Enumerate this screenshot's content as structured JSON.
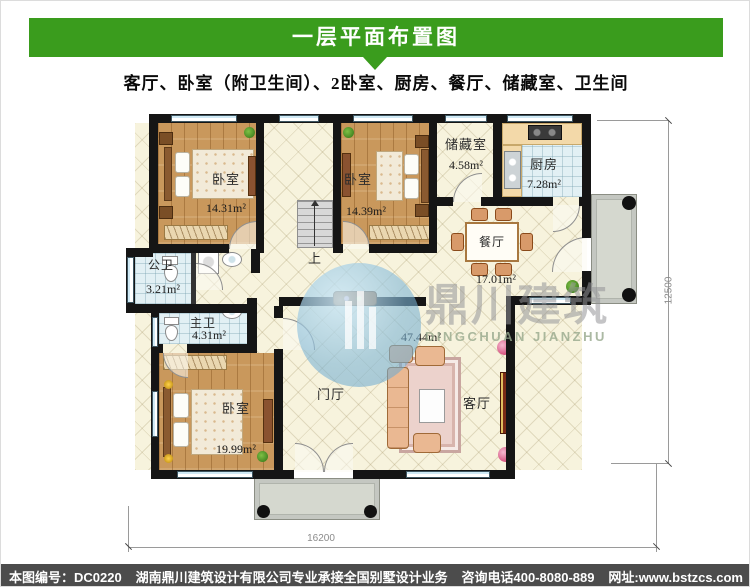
{
  "header": {
    "title": "一层平面布置图",
    "subtitle": "客厅、卧室（附卫生间）、2卧室、厨房、餐厅、储藏室、卫生间"
  },
  "colors": {
    "accent_green": "#3a9c1d",
    "footer_bg": "#4c4c4c",
    "watermark_blue": "#7db5d6",
    "wall": "#151515"
  },
  "rooms": {
    "bedroom_nw": {
      "label": "卧室",
      "area": "14.31m²"
    },
    "bedroom_ne": {
      "label": "卧室",
      "area": "14.39m²"
    },
    "storage": {
      "label": "储藏室",
      "area": "4.58m²"
    },
    "kitchen": {
      "label": "厨房",
      "area": "7.28m²"
    },
    "dining": {
      "label": "餐厅",
      "area": "17.01m²"
    },
    "public_bath": {
      "label": "公卫",
      "area": "3.21m²"
    },
    "master_bath": {
      "label": "主卫",
      "area": "4.31m²"
    },
    "bedroom_sw": {
      "label": "卧室",
      "area": "19.99m²"
    },
    "foyer": {
      "label": "门厅"
    },
    "living": {
      "label": "客厅",
      "area": "47.44m²"
    }
  },
  "plan": {
    "stair_up_label": "上"
  },
  "dimensions": {
    "bottom": "16200",
    "right": "12500"
  },
  "watermark": {
    "cn": "鼎川建筑",
    "en": "DINGCHUAN JIANZHU"
  },
  "footer": {
    "sheet_no": "本图编号：DC0220",
    "company": "湖南鼎川建筑设计有限公司专业承接全国别墅设计业务",
    "phone": "咨询电话400-8080-889",
    "website": "网址:www.bstzcs.com"
  }
}
